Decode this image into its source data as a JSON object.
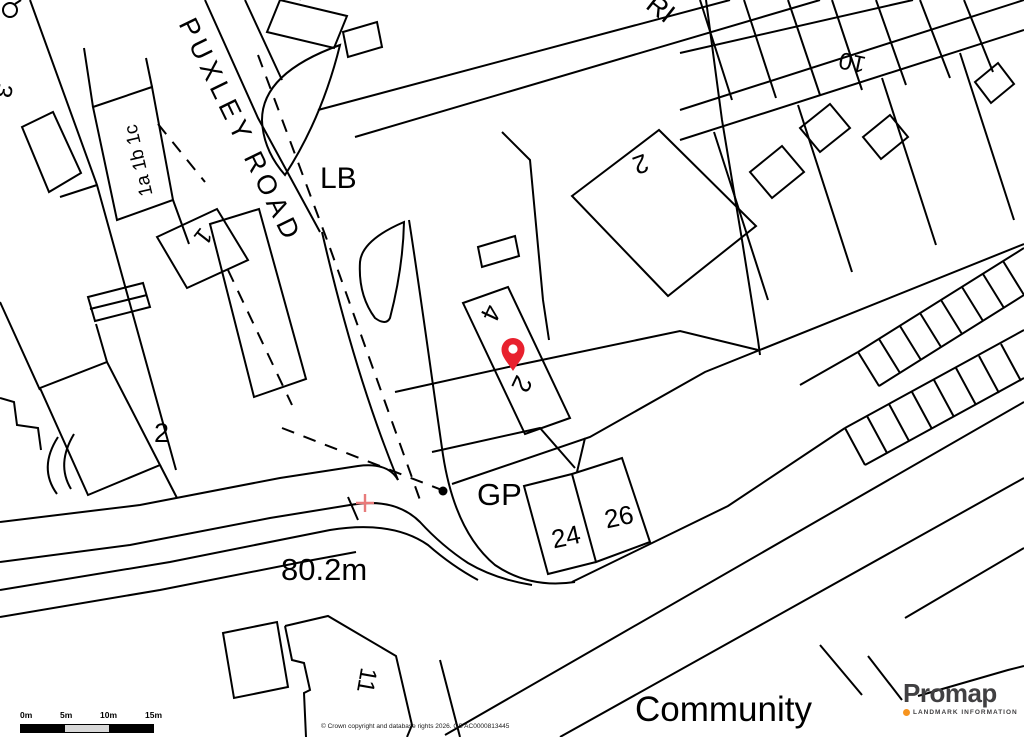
{
  "map": {
    "road_labels": {
      "puxley_road": "PUXLEY ROAD",
      "partial": "RI"
    },
    "area_labels": {
      "lb": "LB",
      "gp": "GP",
      "height": "80.2m",
      "community": "Community"
    },
    "building_numbers": {
      "b3": "3",
      "b8": "8",
      "b1abc": "1a 1b 1c",
      "b1": "1",
      "b2_left": "2",
      "b2_upper": "2",
      "b4": "4",
      "b2_pin": "2",
      "b10": "10",
      "b11": "11",
      "b24": "24",
      "b26": "26"
    }
  },
  "marker": {
    "color": "#E8212E"
  },
  "colors": {
    "line": "#000000",
    "cross": "#E87B7B",
    "scale_mid": "#D8D8D8"
  },
  "scale_bar": {
    "labels": [
      "0m",
      "5m",
      "10m",
      "15m"
    ]
  },
  "attribution": {
    "text": "© Crown copyright and database rights 2026. OS AC0000813445"
  },
  "branding": {
    "name": "Promap",
    "tagline": "LANDMARK INFORMATION",
    "accent_color": "#F7941E",
    "text_color": "#414042"
  }
}
